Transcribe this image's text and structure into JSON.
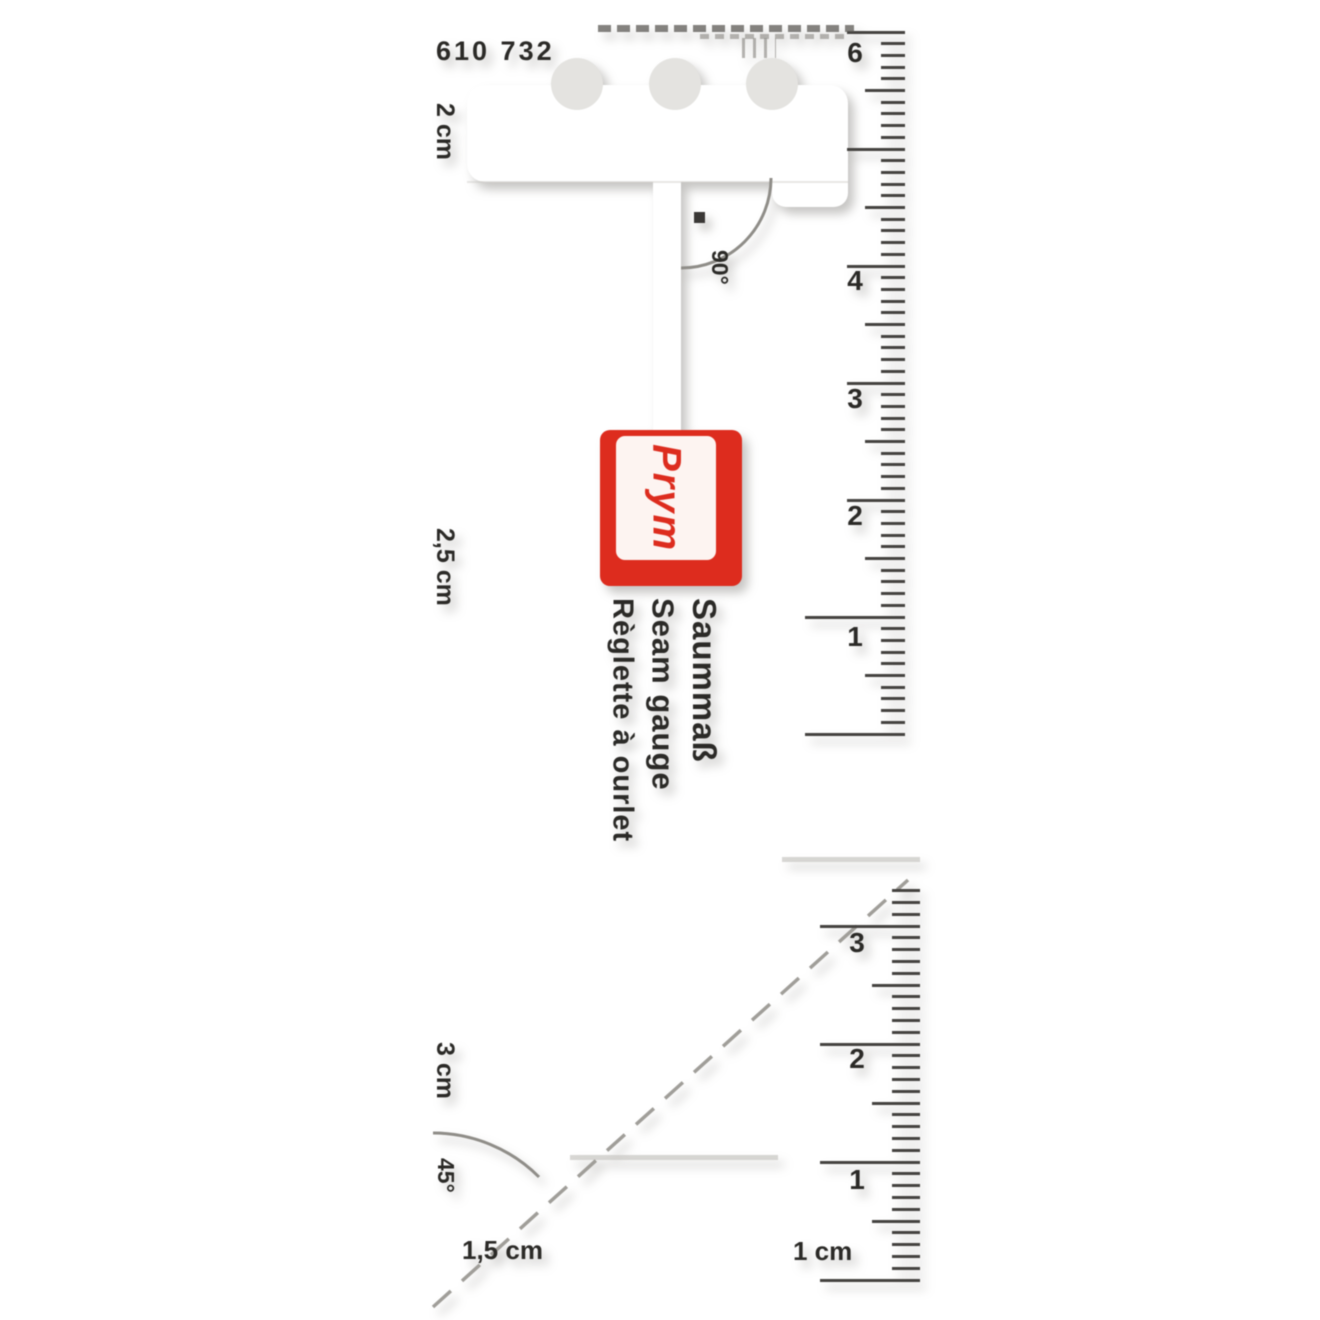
{
  "product": {
    "article_number": "610 732",
    "brand": "Prym",
    "names": {
      "de": "Saummaß",
      "en": "Seam gauge",
      "fr": "Règlette à ourlet"
    }
  },
  "markings": {
    "top_tab_width": "2 cm",
    "middle_tab_width": "2,5 cm",
    "lower_tab_width": "3 cm",
    "bottom_edge_width": "1,5 cm",
    "bottom_slot_width": "1 cm",
    "angle_top": "90°",
    "angle_bottom": "45°"
  },
  "rulers": {
    "upper": {
      "unit": "cm",
      "numbers": [
        "6",
        "4",
        "3",
        "2",
        "1"
      ]
    },
    "lower": {
      "unit": "cm",
      "numbers": [
        "3",
        "2",
        "1"
      ]
    }
  },
  "colors": {
    "brand_red": "#dd2c1e",
    "body_grey": "#e4e3e0",
    "ink": "#2b2a27"
  }
}
